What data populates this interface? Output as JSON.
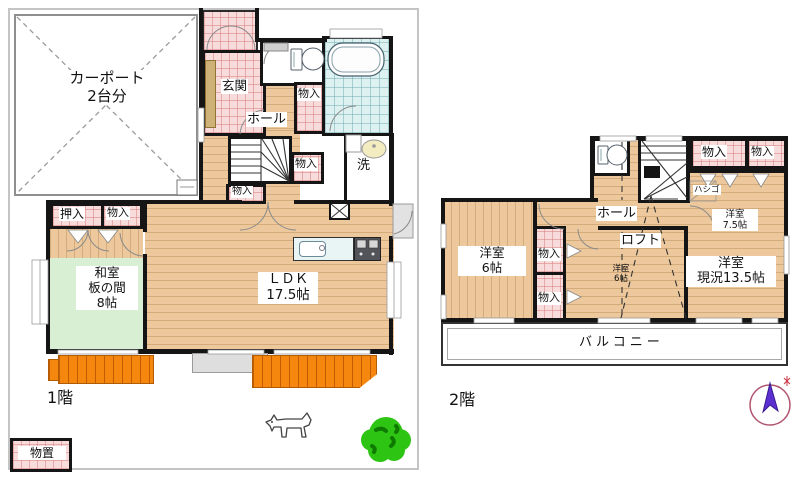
{
  "plan_title": "2-story house floor plan",
  "floor1": {
    "floor_label": "1階",
    "carport": {
      "line1": "カーポート",
      "line2": "2台分"
    },
    "genkan": "玄関",
    "hall": "ホール",
    "storage_by_toilet": "物入",
    "storage_by_wash": "物入",
    "storage_under_stairs": "物入",
    "storage_washitsu": "物入",
    "oshiire": "押入",
    "washitsu": {
      "line1": "和室",
      "line2": "板の間",
      "line3": "8帖"
    },
    "ldk": {
      "line1": "ＬＤＫ",
      "line2": "17.5帖"
    },
    "laundry": "洗",
    "shed": "物置"
  },
  "floor2": {
    "floor_label": "2階",
    "storage_top_left": "物入",
    "storage_top_right": "物入",
    "storage_mid_upper": "物入",
    "storage_mid_lower": "物入",
    "ladder": "ハシゴ",
    "hall": "ホール",
    "loft": "ロフト",
    "west_room_6": {
      "line1": "洋室",
      "line2": "6帖"
    },
    "west_room_75": {
      "line1": "洋室",
      "line2": "7.5帖"
    },
    "west_room_135": {
      "line1": "洋室",
      "line2": "現況13.5帖"
    },
    "west_room_6_small": {
      "line1": "洋室",
      "line2": "6帖"
    },
    "balcony": "バルコニー"
  },
  "icons": {
    "compass": "north-arrow",
    "dog": "dog-illustration",
    "tree": "tree-illustration"
  },
  "colors": {
    "wall": "#151515",
    "wood_floor": "#ecc89c",
    "pink_tile": "#f8dcdc",
    "tatami_green": "#d9efd3",
    "bath_tile": "#def1f1",
    "deck_orange": "#f5870f",
    "tree_green": "#2ec414",
    "compass_arrow": "#5b2fd0",
    "site_border": "#c4c4c4"
  }
}
